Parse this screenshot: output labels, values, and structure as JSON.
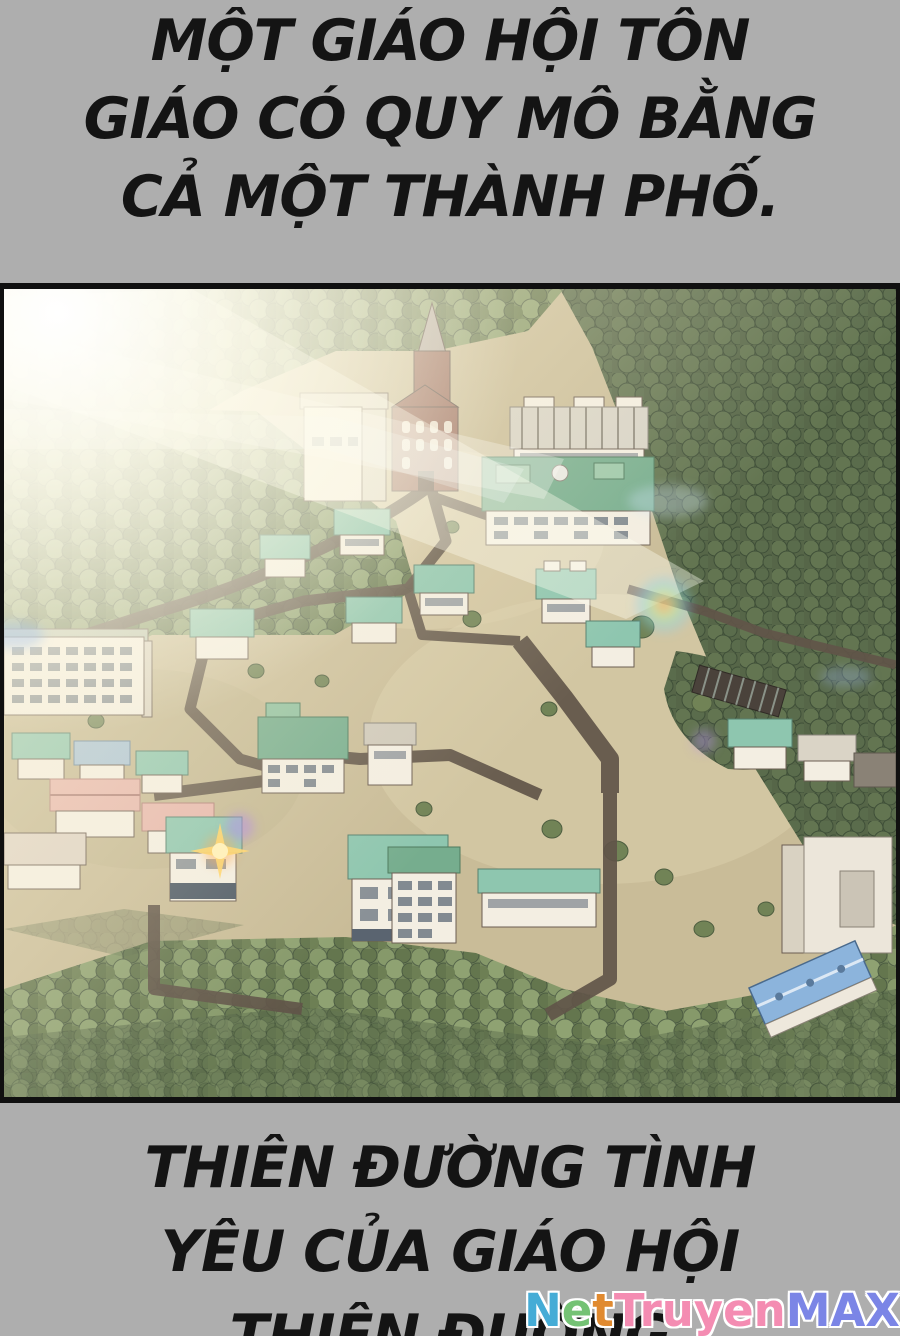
{
  "narration_top": {
    "lines": [
      "MỘT GIÁO HỘI TÔN",
      "GIÁO CÓ QUY MÔ BẰNG",
      "CẢ MỘT THÀNH PHỐ."
    ]
  },
  "narration_bottom": {
    "lines": [
      "THIÊN ĐƯỜNG TÌNH",
      "YÊU CỦA GIÁO HỘI",
      "THIÊN ĐƯỜNG"
    ]
  },
  "watermark": {
    "segments": [
      {
        "text": "N",
        "color": "#45acd6"
      },
      {
        "text": "e",
        "color": "#74c274"
      },
      {
        "text": "t",
        "color": "#e08a30"
      },
      {
        "text": "Truyen",
        "color": "#f48cb2"
      },
      {
        "text": "MAX",
        "color": "#7b85e6"
      }
    ]
  },
  "panel": {
    "palette": {
      "page_bg": "#aeaeae",
      "panel_border": "#101010",
      "text": "#141414",
      "ground": "#c9bc98",
      "ground_light": "#dbcfab",
      "tree_base_light": "#75875c",
      "tree_a": "#86996a",
      "tree_b": "#64764e",
      "tree_base_dark": "#566648",
      "tree_c": "#637551",
      "road": "#615549",
      "wall": "#f3eee2",
      "roof_teal": "#8ec6af",
      "roof_green": "#76ad8e",
      "roof_pink": "#e6b6ac",
      "roof_blue": "#8cb4dc",
      "roof_gray": "#d7d3c7",
      "church": "#996a5c",
      "spire": "#b3a9a2"
    }
  }
}
